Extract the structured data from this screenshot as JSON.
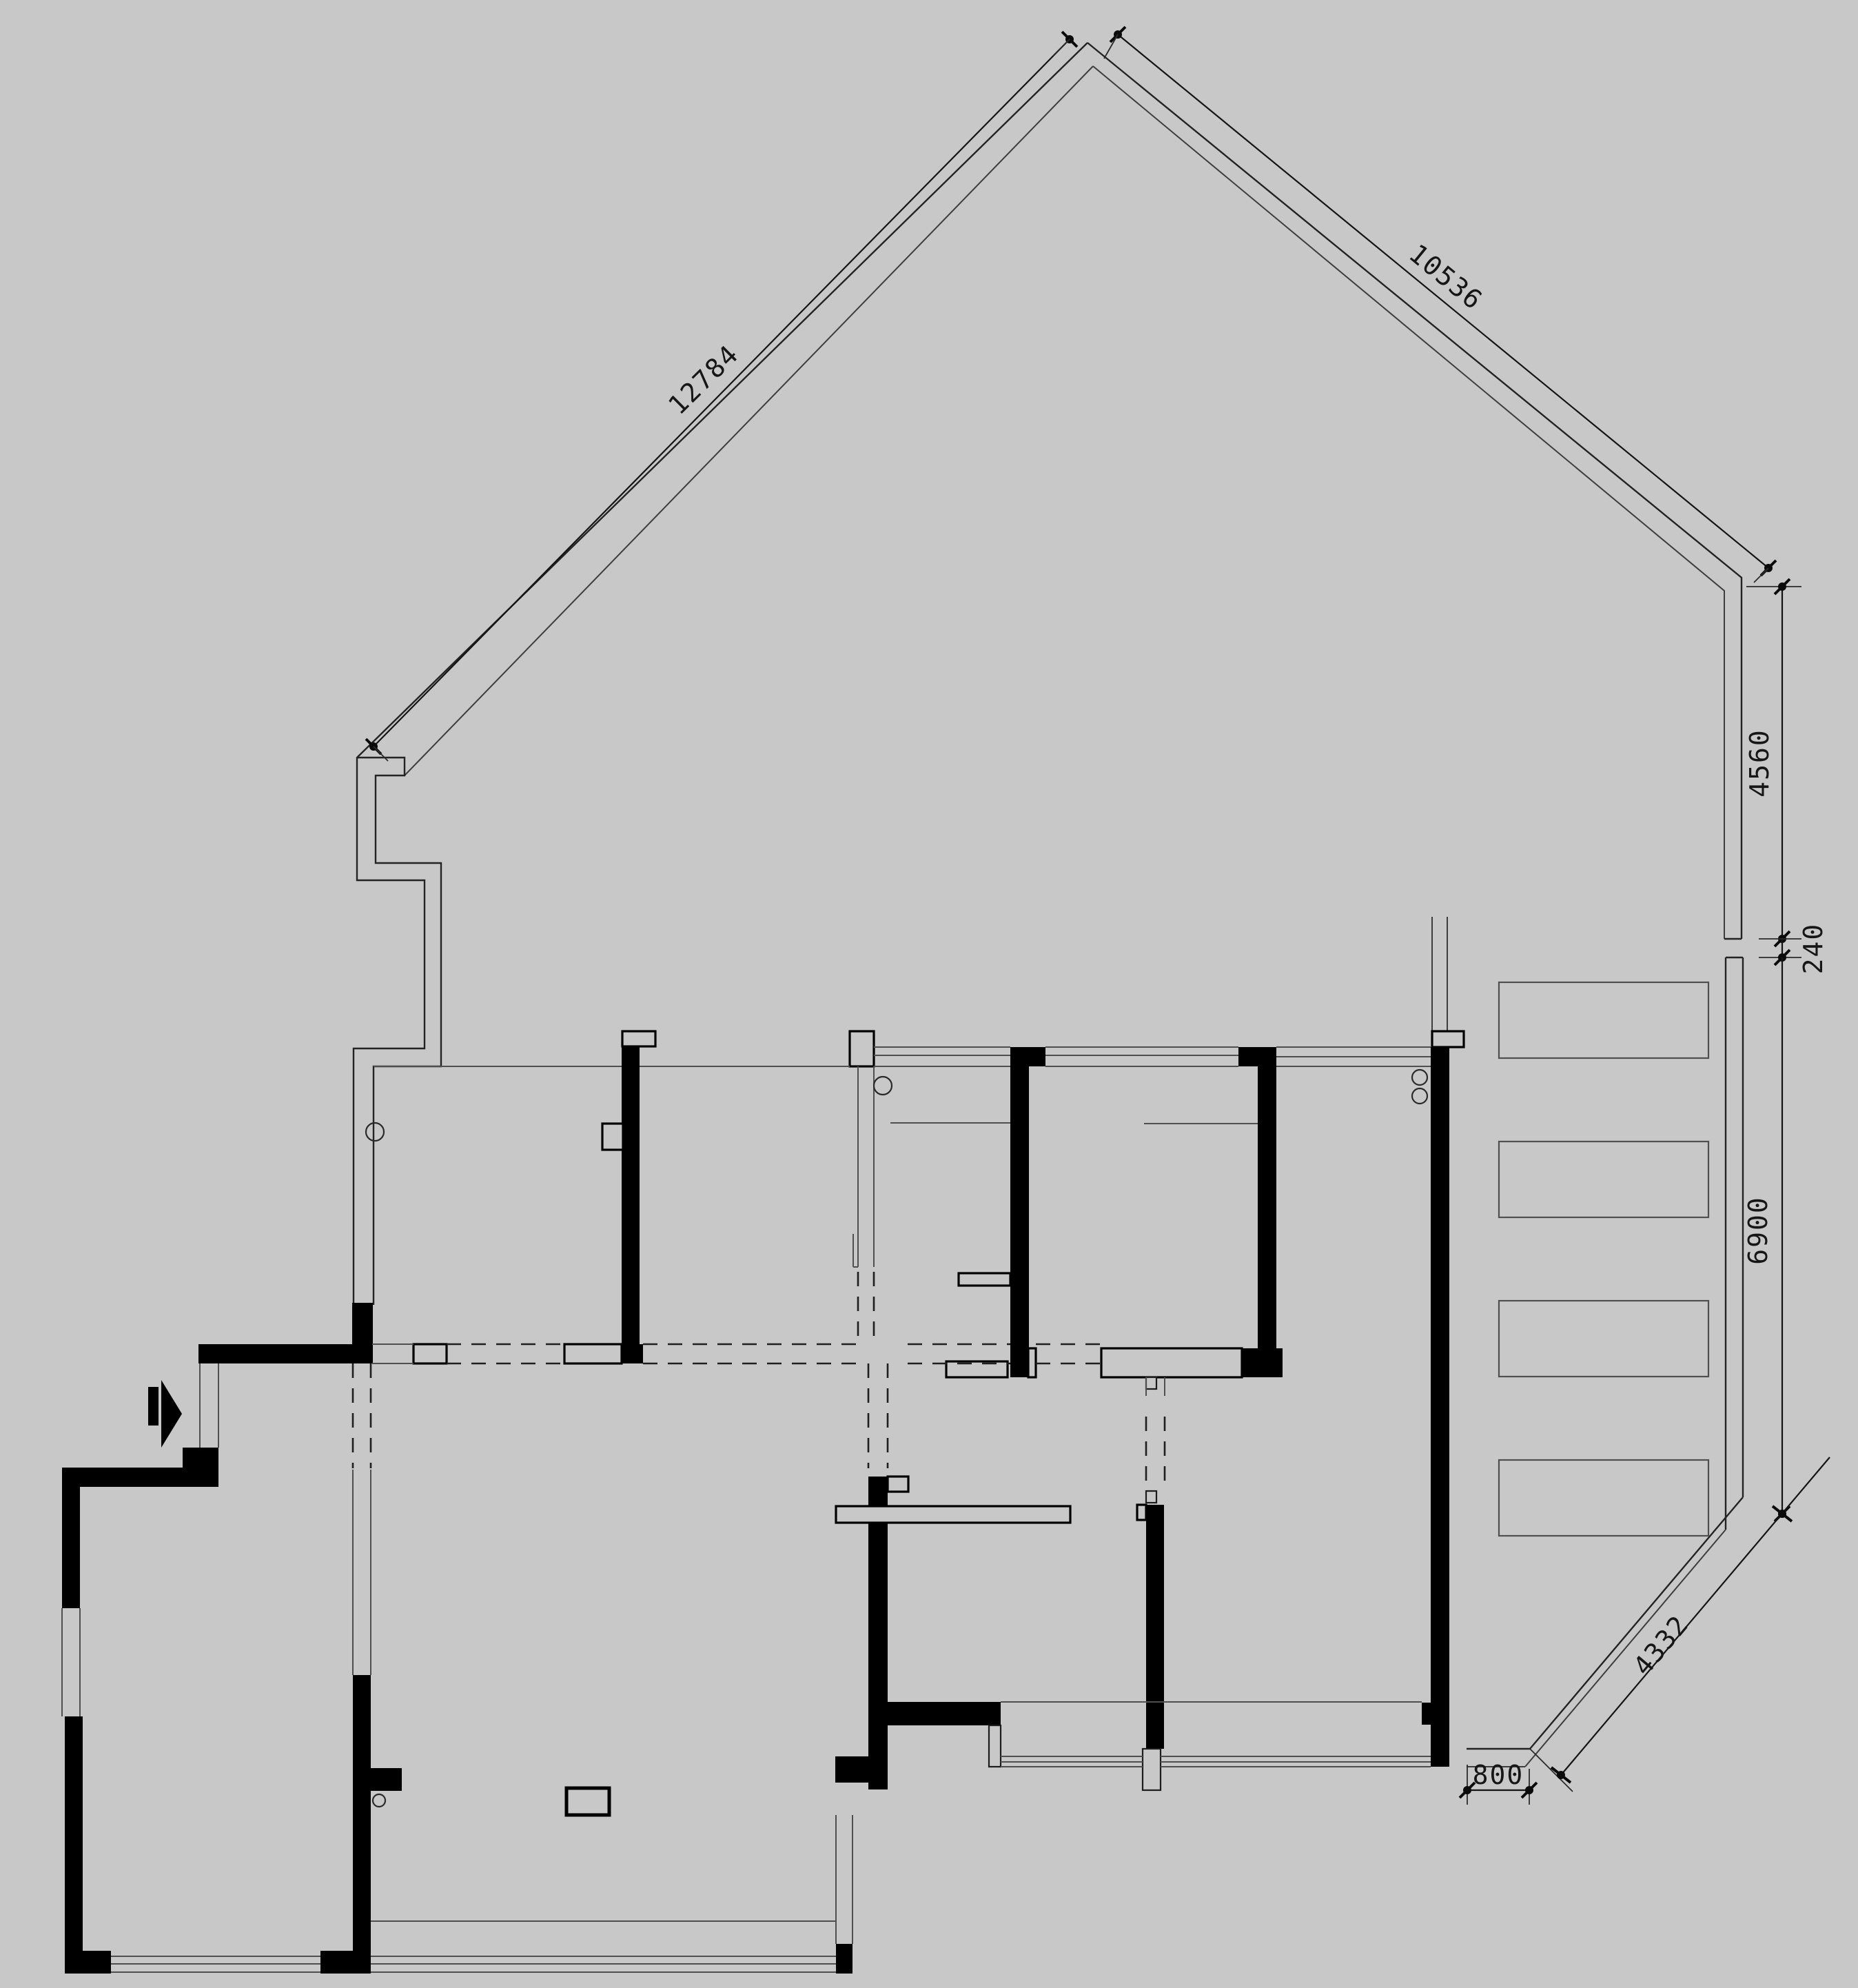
{
  "document": {
    "type": "apartment floor plan",
    "style": "CAD line drawing, demolition/original-structure plan",
    "background_color": "#c8c8c8",
    "wall_color": "#000000",
    "line_color": "#232323"
  },
  "dimensions": {
    "left_roof_diagonal": {
      "label": "12784",
      "orientation": "diagonal-down-left"
    },
    "right_roof_diagonal": {
      "label": "10536",
      "orientation": "diagonal-down-right"
    },
    "right_upper_vertical": {
      "label": "4560",
      "orientation": "vertical"
    },
    "right_jog": {
      "label": "240",
      "orientation": "vertical"
    },
    "right_lower_vertical": {
      "label": "6900",
      "orientation": "vertical"
    },
    "terrace_diagonal": {
      "label": "4332",
      "orientation": "diagonal-down-left"
    },
    "bottom_right_offset": {
      "label": "800",
      "orientation": "horizontal"
    }
  },
  "symbols": {
    "entry_arrow": "entry-direction-arrow pointing right",
    "pipe_markers": "small circles on walls (5)",
    "terrace_boxes": "4 rectangular planter/louver outlines on right terrace",
    "dashed_lines": "demolished partitions / openings",
    "triple_lines": "window and sliding-door bands"
  }
}
